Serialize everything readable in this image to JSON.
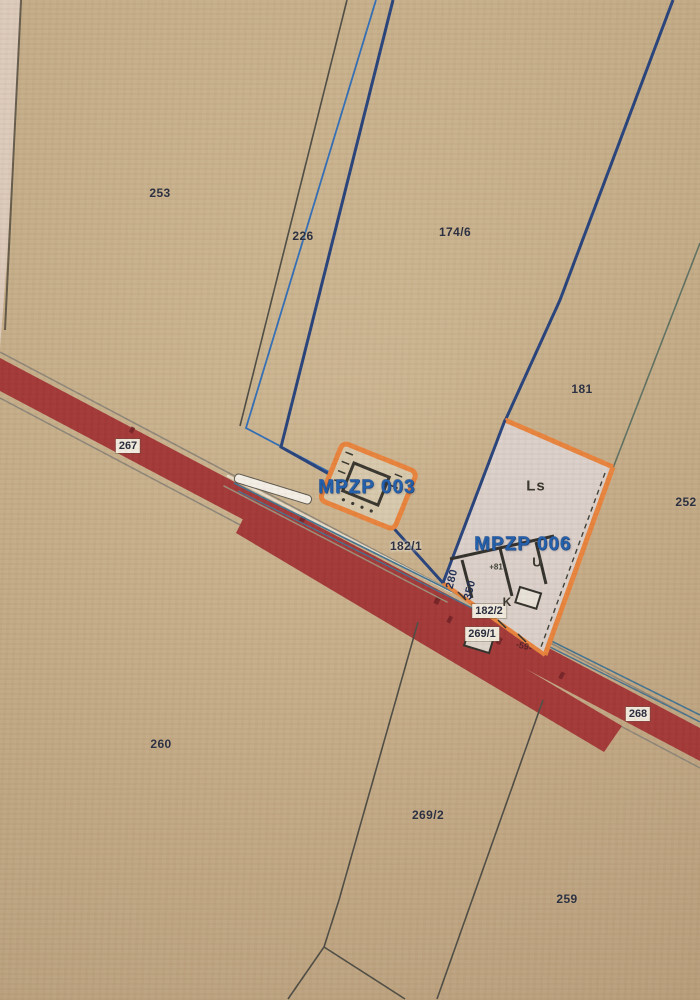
{
  "map": {
    "title": "Cadastral zoning map photo (MPZP plan areas)",
    "plan_areas": [
      {
        "id": "mpzp-003",
        "label": "MPZP 003"
      },
      {
        "id": "mpzp-006",
        "label": "MPZP 006"
      }
    ],
    "labels": {
      "p253": "253",
      "p226": "226",
      "p174_6": "174/6",
      "p181": "181",
      "p252": "252",
      "p267": "267",
      "p268": "268",
      "p260": "260",
      "p269_1": "269/1",
      "p269_2": "269/2",
      "p259": "259",
      "p182_1": "182/1",
      "p182_2": "182/2",
      "mpzp003": "MPZP 003",
      "mpzp006": "MPZP 006",
      "zone_ls": "Ls",
      "zone_u": "U",
      "zone_k": "K",
      "note_81": "+81",
      "m280": "280",
      "m350": "350",
      "m59": "-59-"
    },
    "colors": {
      "paper_tan": "#c9b089",
      "road_red": "#a23636",
      "road_red_dark": "#6e1d22",
      "plan_orange": "#e8823a",
      "plan_label_blue": "#1d5cab",
      "boundary_navy": "#24407a",
      "boundary_blue": "#2f6cb5",
      "boundary_green": "#5d6f60",
      "zone_fill": "#dacfc9",
      "label_box_bg": "#f1eadd",
      "parcel_text": "#262b3e"
    }
  }
}
